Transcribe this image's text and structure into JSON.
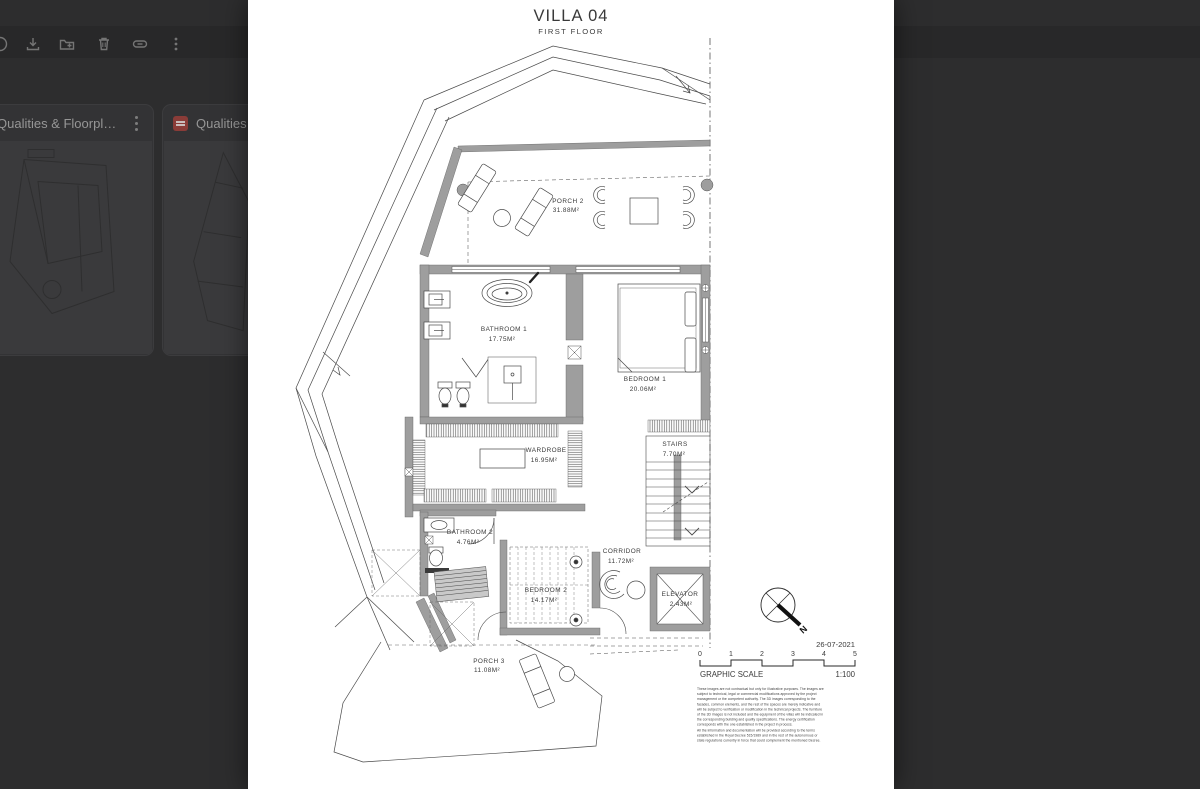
{
  "background": {
    "toolbar": {
      "icons": [
        "print",
        "download",
        "add-to-folder",
        "delete",
        "link",
        "more-options"
      ]
    },
    "cards": [
      {
        "title": "Qualities & Floorpla...",
        "icon": "pdf"
      },
      {
        "title": "Qualities &",
        "icon": "pdf"
      }
    ]
  },
  "document": {
    "title": "VILLA 04",
    "subtitle": "FIRST FLOOR",
    "date": "26-07-2021",
    "compass": "N",
    "scale": {
      "numbers": [
        "0",
        "1",
        "2",
        "3",
        "4",
        "5"
      ],
      "label": "GRAPHIC SCALE",
      "ratio": "1:100"
    },
    "rooms": {
      "porch2": {
        "name": "PORCH 2",
        "area": "31.88M²"
      },
      "bathroom1": {
        "name": "BATHROOM 1",
        "area": "17.75M²"
      },
      "bedroom1": {
        "name": "BEDROOM 1",
        "area": "20.06M²"
      },
      "wardrobe": {
        "name": "WARDROBE",
        "area": "16.95M²"
      },
      "stairs": {
        "name": "STAIRS",
        "area": "7.70M²"
      },
      "bathroom2": {
        "name": "BATHROOM 2",
        "area": "4.76M²"
      },
      "corridor": {
        "name": "CORRIDOR",
        "area": "11.72M²"
      },
      "bedroom2": {
        "name": "BEDROOM 2",
        "area": "14.17M²"
      },
      "elevator": {
        "name": "ELEVATOR",
        "area": "2.43M²"
      },
      "porch3": {
        "name": "PORCH 3",
        "area": "11.08M²"
      }
    },
    "disclaimer_lines": [
      "These images are not contractual but only for illustrative purposes. The images are",
      "subject to technical, legal or commercial modifications approved by the project",
      "management or the competent authority. The 3D images corresponding to the",
      "facades, common elements, and the rest of the spaces are merely indicative and",
      "will be subject to verification or modification in the technical projects. The furniture",
      "of the 3D images is not included and the equipment of the villas will be indicated in",
      "the corresponding building and quality specifications. The energy certification",
      "corresponds with the one established in the project in process.",
      "All the information and documentation will be provided according to the terms",
      "established in the Royal Decree 515/1989 and in the rest of the autonomous or",
      "state regulations currently in force that could complement the mentioned Decree."
    ]
  },
  "colors": {
    "overlay": "#2d2d2e",
    "paper": "#ffffff",
    "pdf_red": "#8a3c38",
    "wall_gray": "#9e9e9e"
  }
}
